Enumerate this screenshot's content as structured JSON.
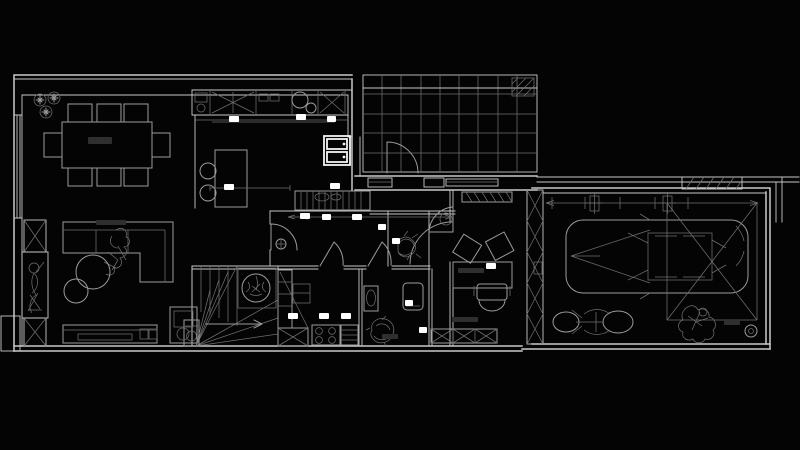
{
  "meta": {
    "view": "architectural-floor-plan-ground-floor",
    "style": "white-line CAD drawing on black background",
    "canvas": {
      "width": 800,
      "height": 450
    }
  },
  "colors": {
    "bg": "#040404",
    "wall": "#c9c9c9",
    "furn": "#9b9b9b",
    "fine": "#6e6e6e",
    "hi": "#f5f5f5",
    "tag": "#ffffff",
    "faint": "#2f2f2f"
  },
  "inventory": {
    "rooms": [
      {
        "name": "dining-living-area",
        "features": [
          "dining-table-8-chairs",
          "plant",
          "l-shaped-sofa",
          "round-coffee-tables",
          "tv-console",
          "fireplace-unit",
          "wardrobe-with-figure",
          "tall-window"
        ]
      },
      {
        "name": "kitchen",
        "features": [
          "wall-cabinet-run",
          "double-sink",
          "cooktop",
          "island-with-stools",
          "refrigerator-highlighted",
          "drawer-counter"
        ]
      },
      {
        "name": "terrace",
        "features": [
          "paving-grid",
          "hatched-corner",
          "door-swing"
        ]
      },
      {
        "name": "hallway",
        "features": [
          "dimension-line",
          "door-swings",
          "column"
        ]
      },
      {
        "name": "staircase",
        "features": [
          "winder-treads",
          "direction-arrow",
          "plant",
          "washing-machine"
        ]
      },
      {
        "name": "utility-room",
        "features": [
          "shelving-x",
          "stove-4-burner",
          "drawer-unit"
        ]
      },
      {
        "name": "bathroom",
        "features": [
          "washbasin",
          "toilet-sketch",
          "shower-tray"
        ]
      },
      {
        "name": "wc",
        "features": [
          "corner-basin",
          "toilet-sketch",
          "door-arc"
        ]
      },
      {
        "name": "office",
        "features": [
          "desk",
          "task-chair",
          "two-cushions",
          "radiator-top",
          "radiator-bottom"
        ]
      },
      {
        "name": "garage",
        "features": [
          "car-top-view",
          "motorcycle",
          "figure-sketch",
          "cross-marked-zone",
          "dimension-arrows",
          "hatched-window",
          "floor-drain"
        ]
      }
    ]
  },
  "dimension_tags": [
    {
      "x": 229,
      "y": 116,
      "w": 10,
      "h": 6
    },
    {
      "x": 296,
      "y": 114,
      "w": 10,
      "h": 6
    },
    {
      "x": 327,
      "y": 116,
      "w": 9,
      "h": 6
    },
    {
      "x": 224,
      "y": 184,
      "w": 10,
      "h": 6
    },
    {
      "x": 330,
      "y": 183,
      "w": 10,
      "h": 6
    },
    {
      "x": 300,
      "y": 213,
      "w": 10,
      "h": 6
    },
    {
      "x": 322,
      "y": 214,
      "w": 9,
      "h": 6
    },
    {
      "x": 352,
      "y": 214,
      "w": 10,
      "h": 6
    },
    {
      "x": 378,
      "y": 224,
      "w": 8,
      "h": 6
    },
    {
      "x": 392,
      "y": 238,
      "w": 8,
      "h": 6
    },
    {
      "x": 486,
      "y": 263,
      "w": 10,
      "h": 6
    },
    {
      "x": 288,
      "y": 313,
      "w": 10,
      "h": 6
    },
    {
      "x": 319,
      "y": 313,
      "w": 10,
      "h": 6
    },
    {
      "x": 341,
      "y": 313,
      "w": 10,
      "h": 6
    },
    {
      "x": 405,
      "y": 300,
      "w": 8,
      "h": 6
    },
    {
      "x": 419,
      "y": 327,
      "w": 8,
      "h": 6
    }
  ],
  "faint_marks": [
    {
      "x": 88,
      "y": 137,
      "w": 24,
      "h": 7
    },
    {
      "x": 96,
      "y": 220,
      "w": 30,
      "h": 5
    },
    {
      "x": 458,
      "y": 268,
      "w": 26,
      "h": 5
    },
    {
      "x": 452,
      "y": 317,
      "w": 26,
      "h": 5
    },
    {
      "x": 382,
      "y": 334,
      "w": 16,
      "h": 5
    },
    {
      "x": 724,
      "y": 320,
      "w": 16,
      "h": 5
    }
  ]
}
